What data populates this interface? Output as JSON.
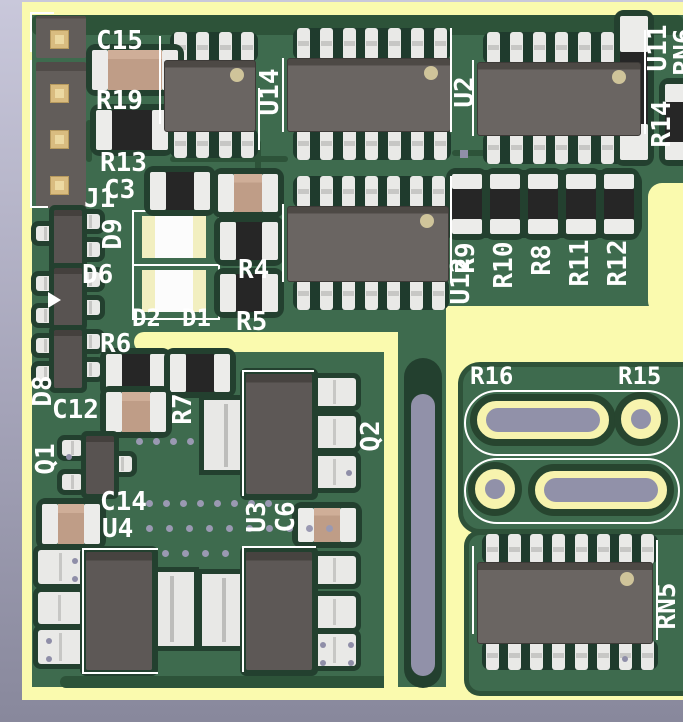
{
  "viewport": {
    "title": "PCB 3D render",
    "width_px": 683,
    "height_px": 722
  },
  "colors": {
    "background_top": "#c9c8db",
    "background_bottom": "#88889c",
    "soldermask_green": "#3e6b4e",
    "trace_dark_green": "#2d5339",
    "recess_green": "#23402f",
    "zone_yellow": "#fafaae",
    "silkscreen_white": "#ffffff",
    "ic_body_gray": "#6a6562",
    "pin_silver": "#e9e9e7",
    "capacitor_tan": "#bf9d87",
    "resistor_black": "#262626",
    "header_pad_gold": "#d9bc80",
    "hole_purple": "#9191a9",
    "via_purple": "#9a99b2"
  },
  "labels": {
    "j1": "J1",
    "c15": "C15",
    "r19": "R19",
    "r13": "R13",
    "c3": "C3",
    "u14": "U14",
    "u2": "U2",
    "u11": "U11",
    "rn6": "RN6",
    "r14": "R14",
    "d9": "D9",
    "d6": "D6",
    "d2": "D2",
    "d1": "D1",
    "r4": "R4",
    "r5": "R5",
    "u12": "U12",
    "r9": "R9",
    "r10": "R10",
    "r8": "R8",
    "r11": "R11",
    "r12": "R12",
    "r6": "R6",
    "d8": "D8",
    "c12": "C12",
    "r7": "R7",
    "q1": "Q1",
    "q2": "Q2",
    "c14": "C14",
    "u4": "U4",
    "u3": "U3",
    "c6": "C6",
    "r16": "R16",
    "r15": "R15",
    "rn5": "RN5"
  }
}
